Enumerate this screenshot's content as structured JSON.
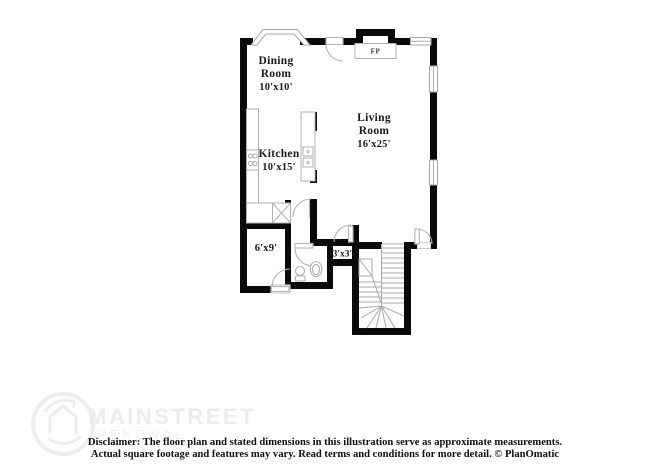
{
  "floor_plan": {
    "rooms": [
      {
        "name": "dining-room",
        "lines": [
          "Dining",
          "Room",
          "10'x10'"
        ]
      },
      {
        "name": "living-room",
        "lines": [
          "Living",
          "Room",
          "16'x25'"
        ]
      },
      {
        "name": "kitchen",
        "lines": [
          "Kitchen",
          "10'x15'"
        ]
      },
      {
        "name": "room-6x9",
        "lines": [
          "6'x9'"
        ]
      },
      {
        "name": "closet-3x3",
        "lines": [
          "3'x3'"
        ]
      }
    ],
    "fireplace_label": "FP"
  },
  "branding": {
    "name_line1": "MAINSTREET",
    "name_line2": "RENEWAL"
  },
  "footer": {
    "disclaimer_line1": "Disclaimer: The floor plan and stated dimensions in this illustration serve as approximate measurements.",
    "disclaimer_line2": "Actual square footage and features may vary. Read terms and conditions for more detail. © PlanOmatic"
  },
  "colors": {
    "wall": "#0a0a0a",
    "fixture_line": "#b0b0b0",
    "label_text": "#1a1a1a",
    "watermark": "#ededed"
  }
}
